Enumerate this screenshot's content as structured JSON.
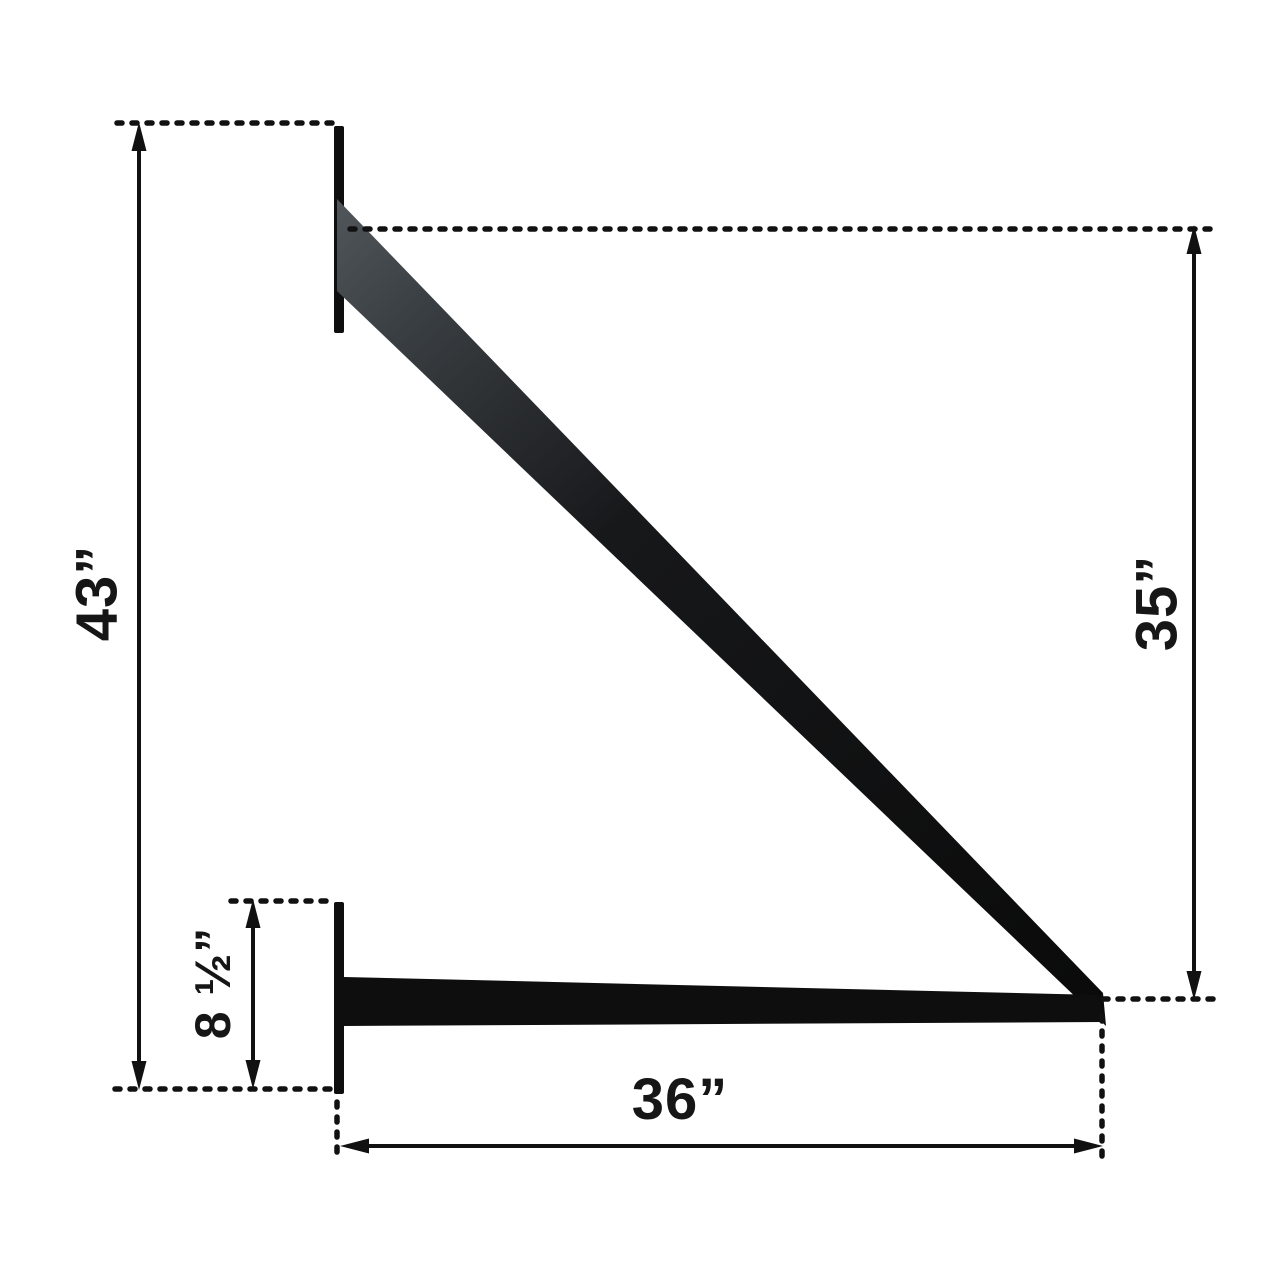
{
  "diagram": {
    "type": "dimension-drawing",
    "subject": "wall-mount triangle support bracket side view",
    "background_color": "#ffffff",
    "ink_color": "#111111",
    "bracket_color": "#0e0e0e",
    "dimensions": [
      {
        "name": "overall-height",
        "label": "43”",
        "orientation": "vertical",
        "side": "left"
      },
      {
        "name": "brace-drop-height",
        "label": "35”",
        "orientation": "vertical",
        "side": "right"
      },
      {
        "name": "mount-plate-height",
        "label": "8 ½”",
        "orientation": "vertical",
        "side": "left-inner"
      },
      {
        "name": "arm-length",
        "label": "36”",
        "orientation": "horizontal",
        "side": "bottom"
      }
    ]
  }
}
